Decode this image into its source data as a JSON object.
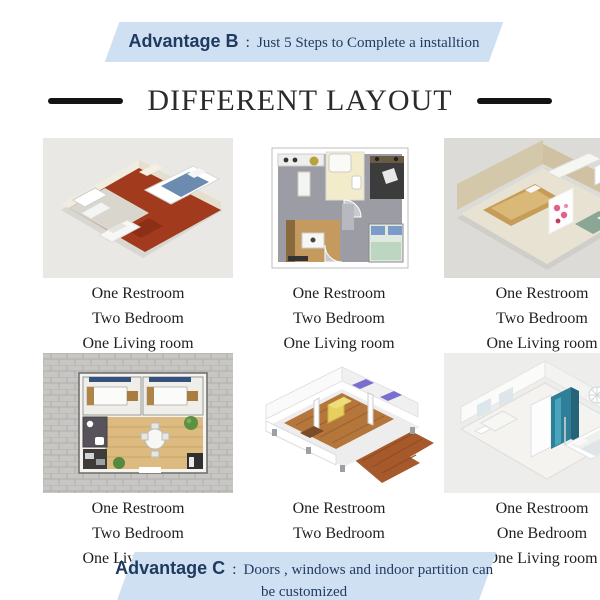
{
  "banner_top": {
    "label": "Advantage B",
    "separator": ":",
    "text": "Just 5 Steps to Complete a installtion"
  },
  "title": {
    "text": "DIFFERENT LAYOUT"
  },
  "cards": [
    {
      "image": "floorplan-3d-red-floor",
      "lines": [
        "One Restroom",
        "Two Bedroom",
        "One Living room"
      ]
    },
    {
      "image": "floorplan-2d-gray-topdown",
      "lines": [
        "One Restroom",
        "Two Bedroom",
        "One Living room"
      ]
    },
    {
      "image": "floorplan-3d-beige",
      "lines": [
        "One Restroom",
        "Two Bedroom",
        "One Living room"
      ]
    },
    {
      "image": "floorplan-2d-pavers",
      "lines": [
        "One Restroom",
        "Two Bedroom",
        "One Living room"
      ]
    },
    {
      "image": "floorplan-3d-white-deck",
      "lines": [
        "One Restroom",
        "Two Bedroom",
        "One Living room"
      ]
    },
    {
      "image": "floorplan-3d-white-teal",
      "lines": [
        "One Restroom",
        "One Bedroom",
        "One Living room"
      ]
    }
  ],
  "banner_bottom": {
    "label": "Advantage C",
    "separator": ":",
    "text": "Doors , windows and indoor partition  can",
    "text_line2": "be customized"
  },
  "colors": {
    "banner_bg": "#cfe0f3",
    "banner_text": "#1f3a5f",
    "title_color": "#2b2b2b",
    "caption_color": "#1f1f1f",
    "dash_color": "#141414"
  }
}
